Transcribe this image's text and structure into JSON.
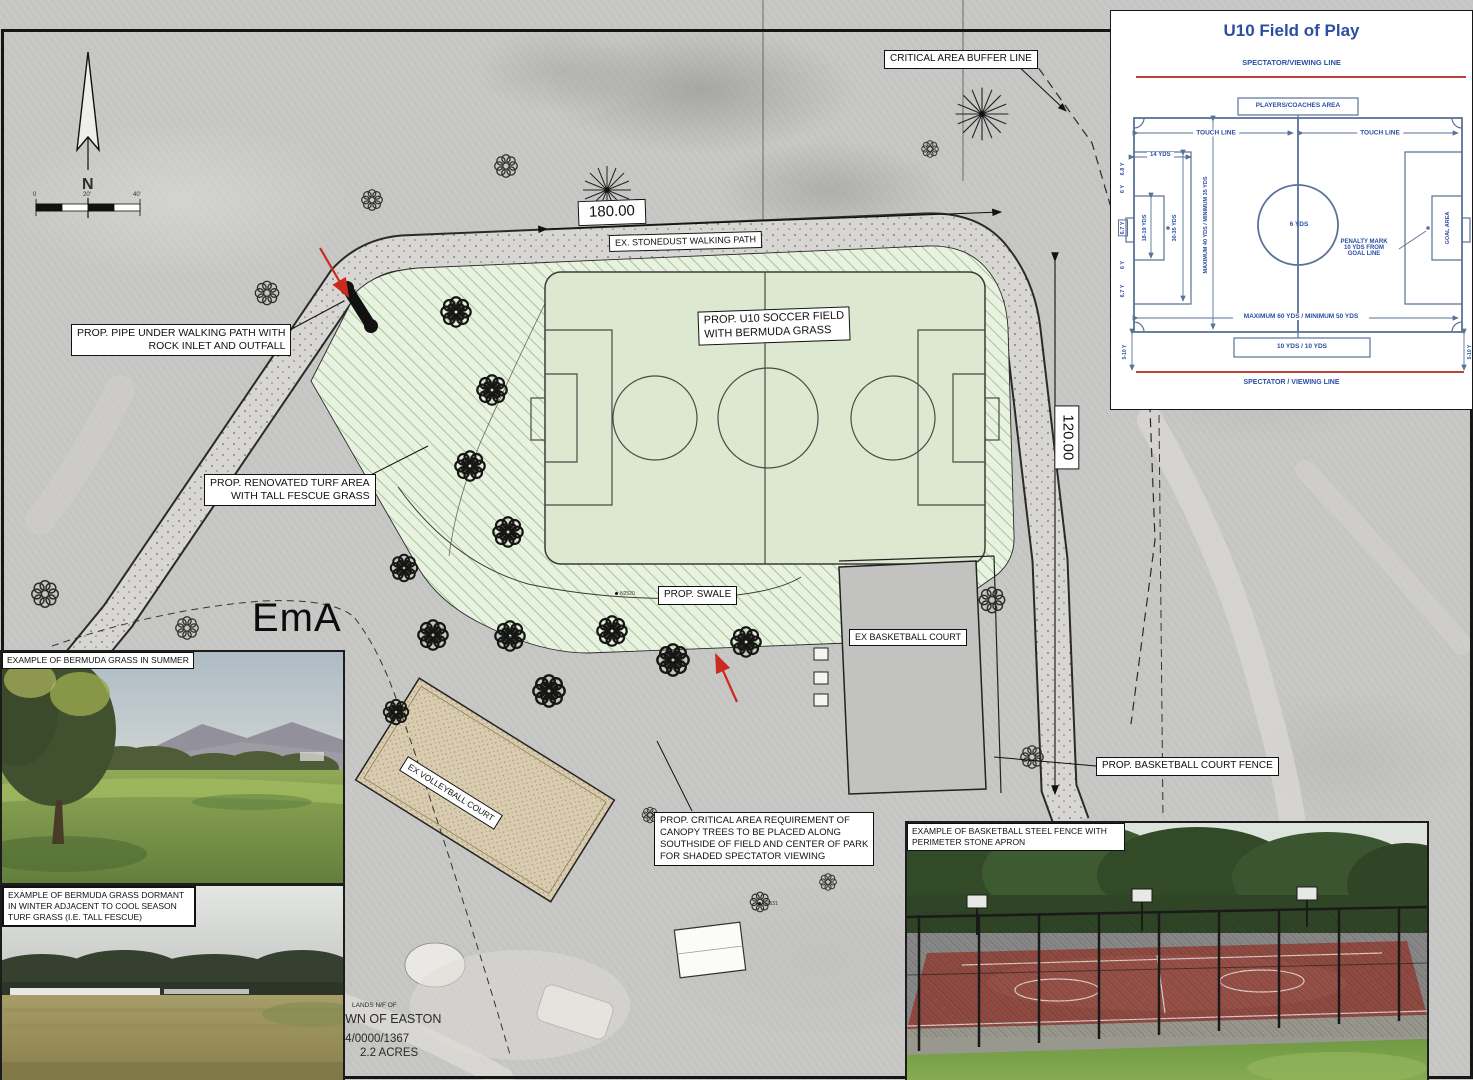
{
  "plan": {
    "labels": {
      "buffer_line": "CRITICAL AREA BUFFER LINE",
      "walking_path": "EX. STONEDUST WALKING PATH",
      "soccer_field": "PROP. U10 SOCCER FIELD\nWITH BERMUDA GRASS",
      "pipe": "PROP. PIPE UNDER WALKING PATH WITH\nROCK INLET AND OUTFALL",
      "turf": "PROP. RENOVATED TURF AREA\nWITH TALL FESCUE GRASS",
      "swale": "PROP. SWALE",
      "basketball_court": "EX BASKETBALL COURT",
      "volleyball_court": "EX VOLLEYBALL COURT",
      "basketball_fence": "PROP. BASKETBALL COURT FENCE",
      "canopy_note": "PROP. CRITICAL AREA REQUIREMENT OF\nCANOPY TREES TO BE PLACED ALONG\nSOUTHSIDE OF FIELD AND CENTER OF PARK\nFOR SHADED SPECTATOR VIEWING"
    },
    "dimensions": {
      "width": "180.00",
      "height": "120.00"
    },
    "soil_label": "EmA",
    "north_label": "N",
    "scale_ticks": [
      "0",
      "20'",
      "40'"
    ],
    "parcel": {
      "lands": "LANDS N/F OF",
      "owner": "TOWN OF EASTON",
      "parcel_id": "0104/0000/1367",
      "area": "2.2 ACRES"
    },
    "spot_markers": [
      "N2520",
      "N2531"
    ]
  },
  "inset": {
    "title": "U10 Field of Play",
    "spectator_top": "SPECTATOR/VIEWING LINE",
    "players_area": "PLAYERS/COACHES AREA",
    "touch_line": "TOUCH LINE",
    "width_dim": "MAXIMUM 40 YDS / MINIMUM 35 YDS",
    "length_dim": "MAXIMUM 60 YDS / MINIMUM 50 YDS",
    "center_circle": "6 YDS",
    "penalty_depth": "14 YDS",
    "goal_area_span": "18-19 YDS",
    "penalty_span": "30-35 YDS",
    "goal_segs": [
      "6.8 Y",
      "6 Y",
      "6.7 Y",
      "6 Y",
      "6.7 Y"
    ],
    "goal_area_label": "GOAL AREA",
    "penalty_note": "PENALTY MARK\n10 YDS FROM\nGOAL LINE",
    "goal_bottom": "10 YDS / 10 YDS",
    "corner_dim": "5-10 Y",
    "spectator_bottom": "SPECTATOR / VIEWING LINE"
  },
  "photos": {
    "summer": {
      "caption": "EXAMPLE OF BERMUDA GRASS IN SUMMER"
    },
    "dormant": {
      "caption": "EXAMPLE OF BERMUDA GRASS DORMANT IN WINTER ADJACENT TO COOL SEASON TURF GRASS (I.E. TALL FESCUE)"
    },
    "fence": {
      "caption": "EXAMPLE OF BASKETBALL STEEL FENCE WITH PERIMETER STONE APRON"
    }
  },
  "colors": {
    "inset_blue": "#2b4ea3",
    "inset_line": "#5a7296",
    "spectator_red": "#c0403c",
    "hatch_green": "#8cc084",
    "field_green": "#dce8d0",
    "slope_arrow_red": "#cc2a1e"
  }
}
